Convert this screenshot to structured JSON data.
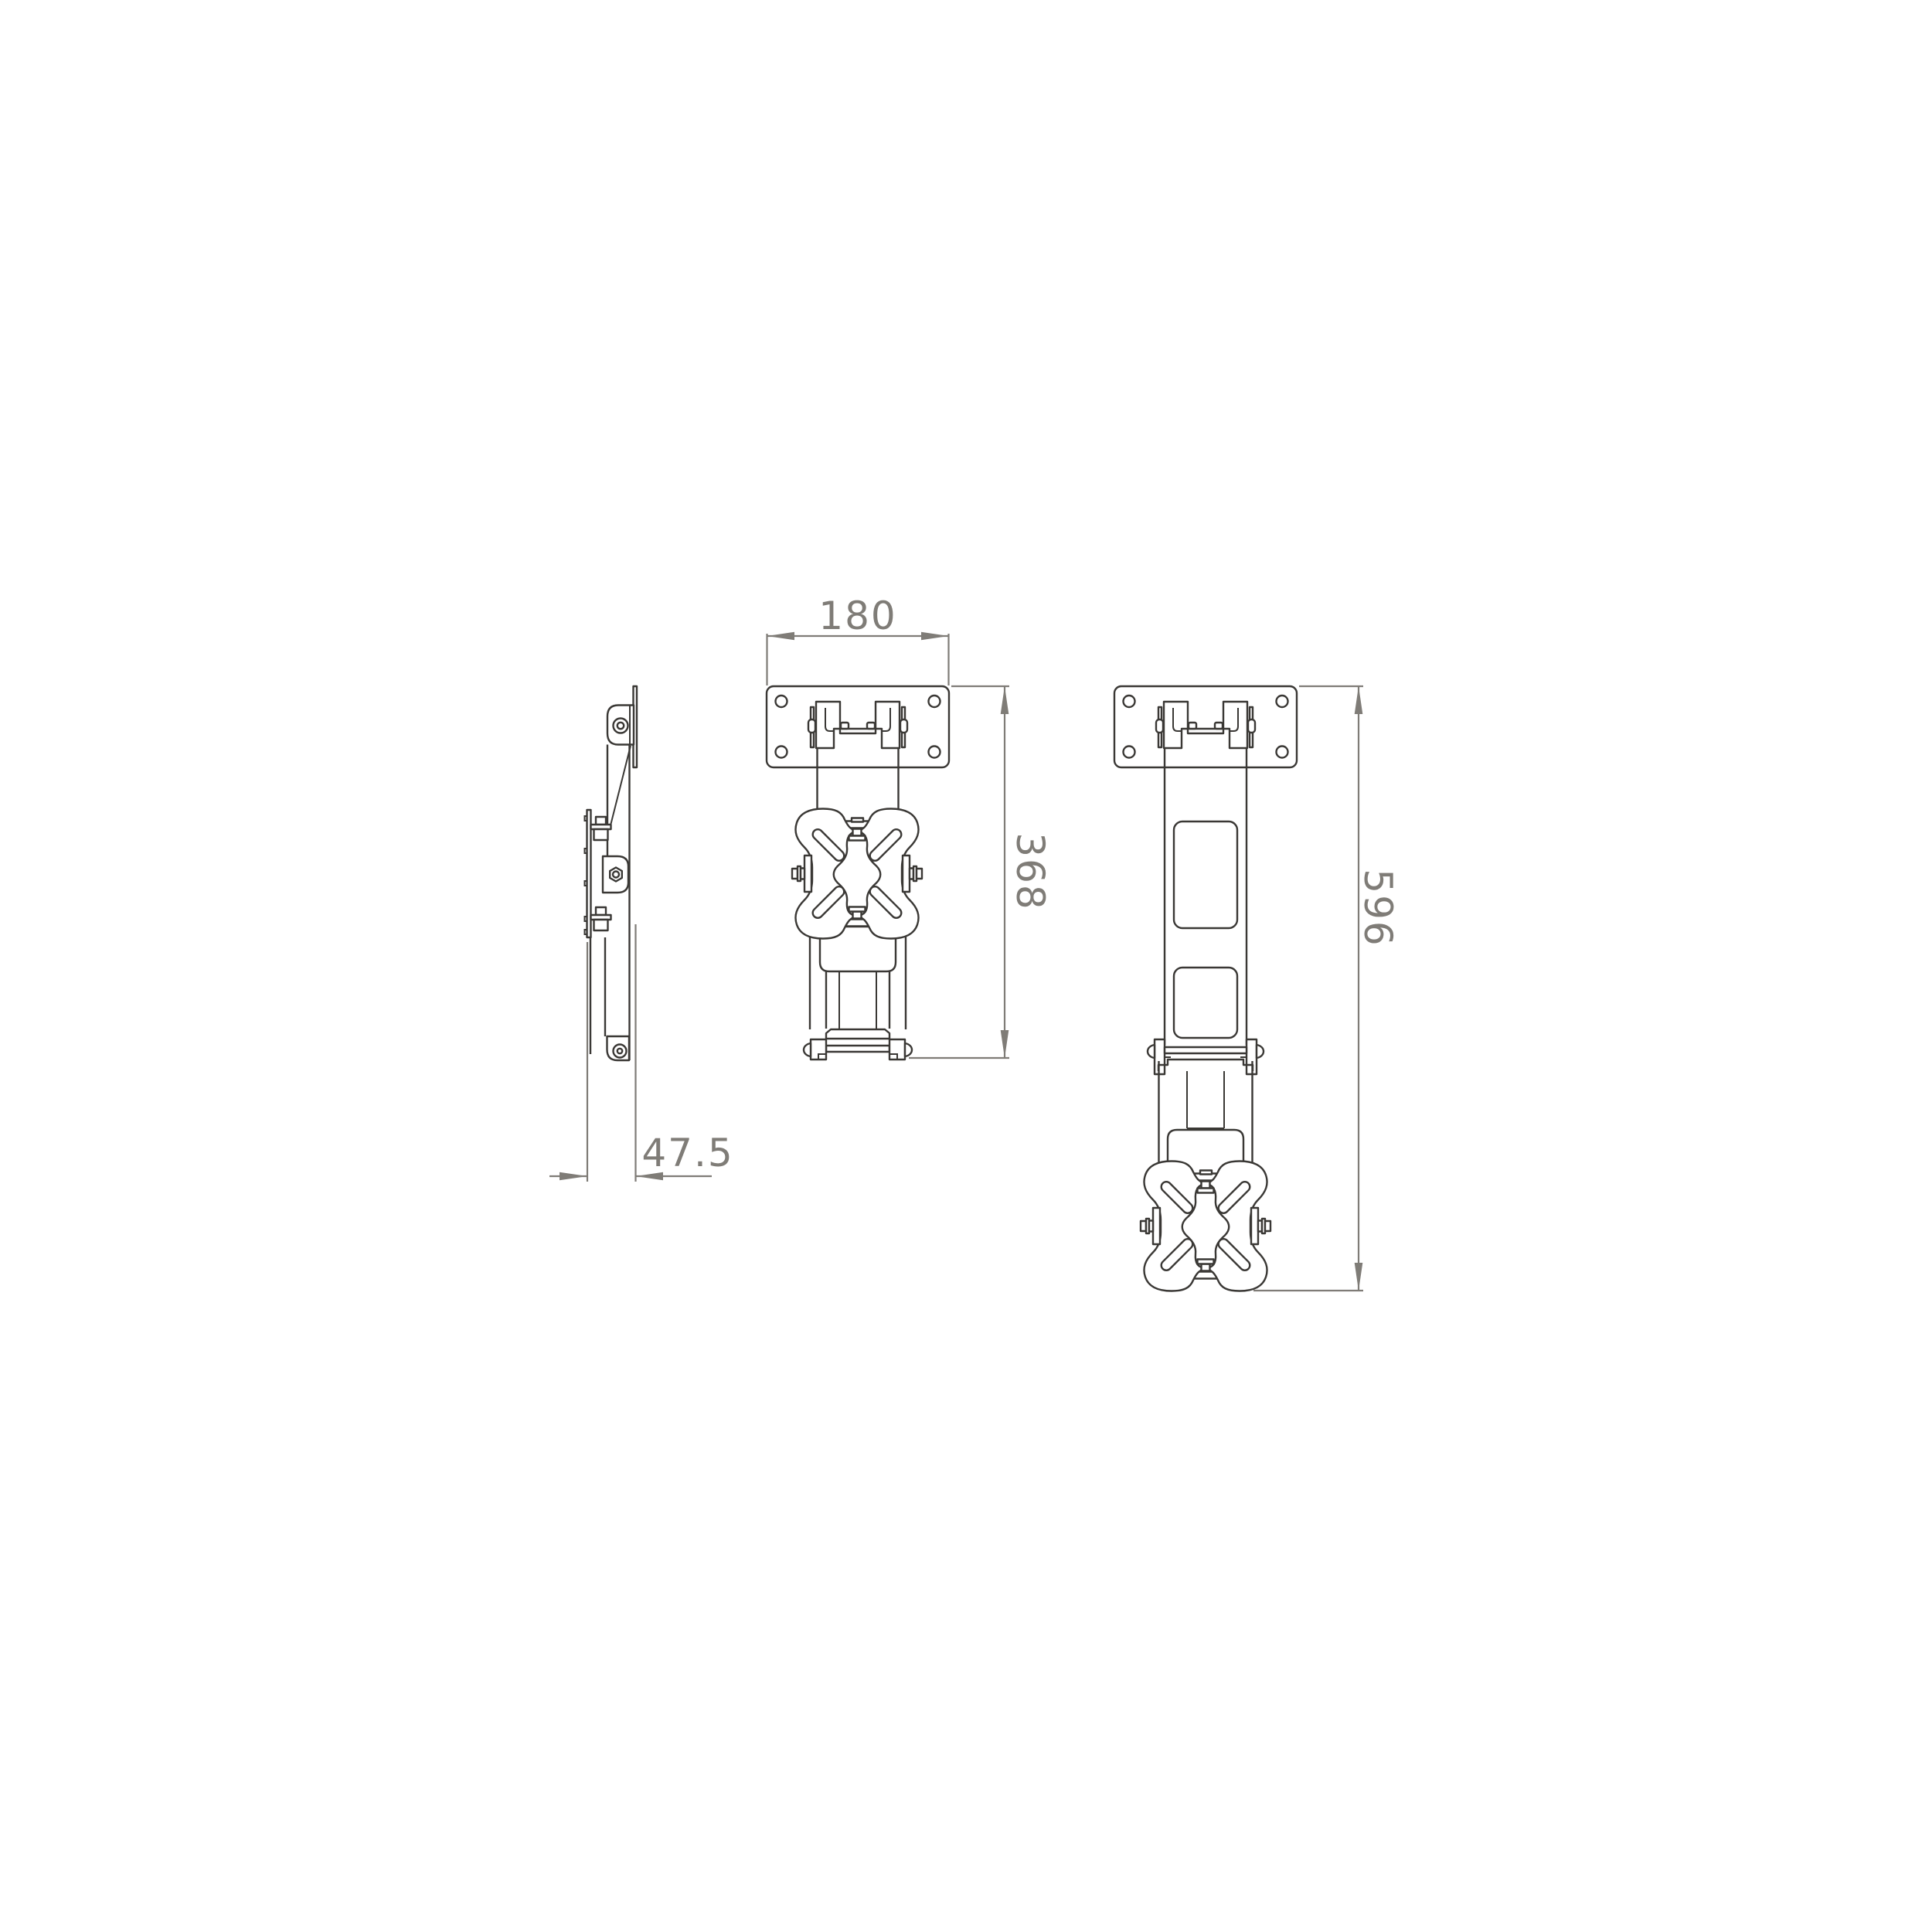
{
  "drawing": {
    "background_color": "#ffffff",
    "part_line_color": "#3a3835",
    "dimension_color": "#7f7c77",
    "views": {
      "side": {
        "dimensions": {
          "depth": {
            "label": "47.5"
          }
        }
      },
      "front_retracted": {
        "dimensions": {
          "plate_width": {
            "label": "180"
          },
          "retracted_length": {
            "label": "368"
          }
        }
      },
      "front_extended": {
        "dimensions": {
          "extended_length": {
            "label": "596"
          }
        }
      }
    }
  }
}
